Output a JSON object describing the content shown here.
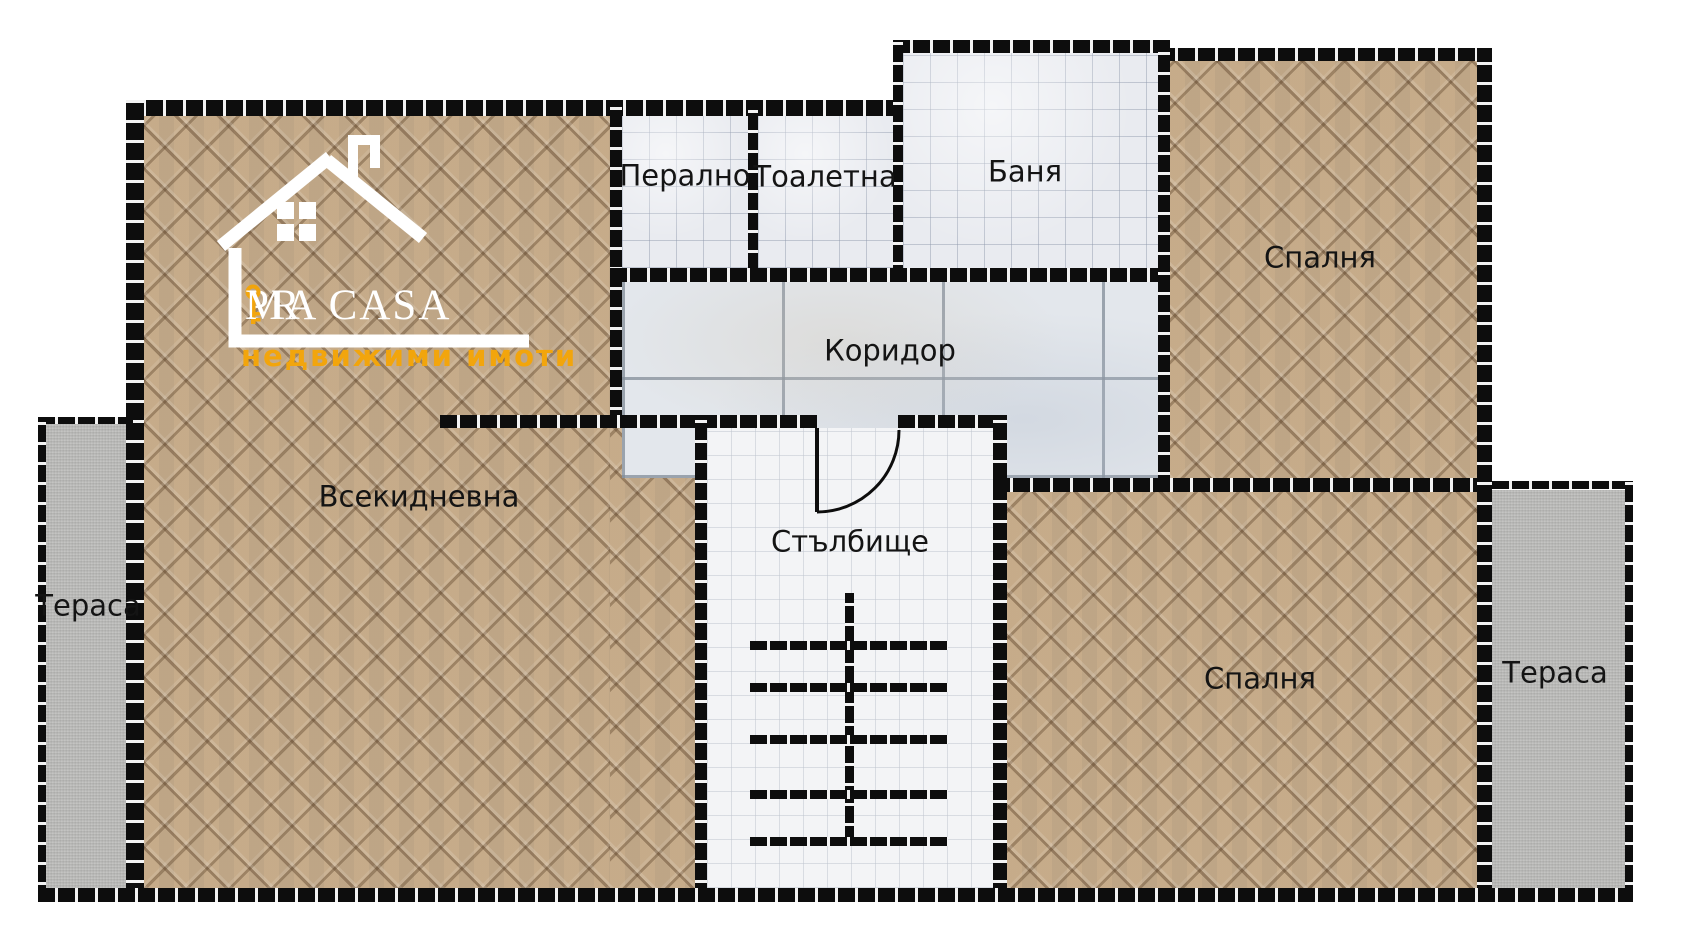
{
  "title": "Apartment floor plan",
  "brand": {
    "name_part1": "PR",
    "name_part2": "MA CASA",
    "tagline": "недвижими имоти",
    "accent_color": "#F2A50C",
    "text_color": "#FFFFFF"
  },
  "rooms": {
    "living": {
      "label": "Всекидневна"
    },
    "laundry": {
      "label": "Перално"
    },
    "toilet": {
      "label": "Тоалетна"
    },
    "bath": {
      "label": "Баня"
    },
    "corridor": {
      "label": "Коридор"
    },
    "staircase": {
      "label": "Стълбище"
    },
    "bedroom_top": {
      "label": "Спалня"
    },
    "bedroom_bottom": {
      "label": "Спалня"
    },
    "terrace_left": {
      "label": "Тераса"
    },
    "terrace_right": {
      "label": "Тераса"
    }
  },
  "palette": {
    "wall": "#0D0D0D",
    "parquet": "#C9B08F",
    "small_tile": "#E9EBF0",
    "marble_tile": "#E3E7EC",
    "stair_floor": "#F3F4F6",
    "terrace": "#BDBDBB",
    "label_text": "#141414"
  }
}
